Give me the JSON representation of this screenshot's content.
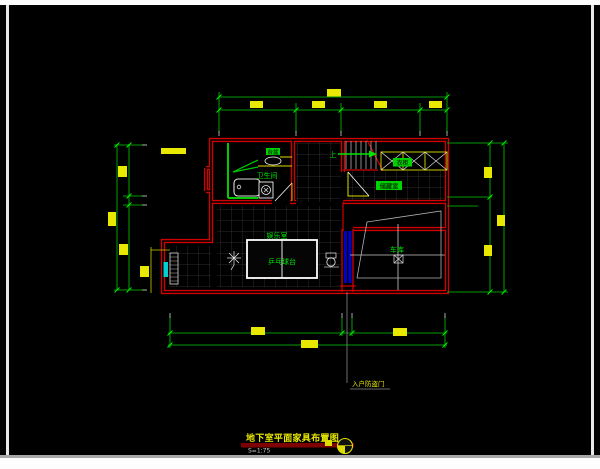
{
  "title_block": {
    "title": "地下室平面家具布置图",
    "scale": "S=1:75"
  },
  "plan": {
    "rooms": {
      "bathroom": "卫生间",
      "entertainment": "娱乐室",
      "pingpong_table": "乒乓球台",
      "garage": "车库",
      "storage": "储藏室"
    },
    "fixtures": {
      "cabinet_label": "衣柜",
      "vanity_label": "台盆"
    },
    "stair_direction": "上",
    "door_note": "入户防盗门"
  },
  "icons": {
    "detail_bubble": "detail-bubble-icon",
    "north_door_leader": "leader-line"
  },
  "colors": {
    "wall_red": "#d40000",
    "dim_green": "#00cc00",
    "label_green": "#00e600",
    "dim_text_yellow": "#e8e800",
    "door_blue": "#0000d0",
    "window_cyan": "#00d0d0",
    "tile_gray": "#383838",
    "canvas_black": "#000000"
  }
}
